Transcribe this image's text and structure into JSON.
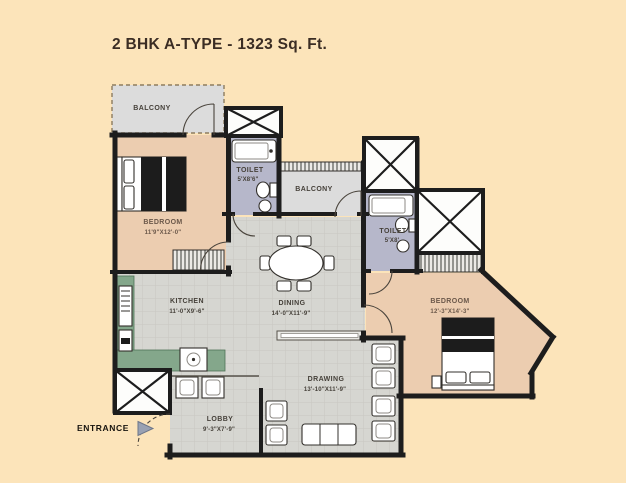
{
  "title": "2 BHK A-TYPE - 1323 Sq. Ft.",
  "entrance": {
    "label": "ENTRANCE"
  },
  "rooms": {
    "balcony_top": {
      "name": "BALCONY"
    },
    "bedroom_left": {
      "name": "BEDROOM",
      "dims": "11'9\"X12'-0\""
    },
    "toilet_top": {
      "name": "TOILET",
      "dims": "5'X8'6\""
    },
    "balcony_mid": {
      "name": "BALCONY"
    },
    "toilet_right": {
      "name": "TOILET",
      "dims": "5'X8'"
    },
    "bedroom_right": {
      "name": "BEDROOM",
      "dims": "12'-3\"X14'-3\""
    },
    "kitchen": {
      "name": "KITCHEN",
      "dims": "11'-0\"X9'-6\""
    },
    "dining": {
      "name": "DINING",
      "dims": "14'-0\"X11'-9\""
    },
    "drawing": {
      "name": "DRAWING",
      "dims": "13'-10\"X11'-9\""
    },
    "lobby": {
      "name": "LOBBY",
      "dims": "9'-3\"X7'-9\""
    }
  },
  "colors": {
    "background": "#fce4ba",
    "wall": "#1d1d1d",
    "bedroom_floor": "#eccdb0",
    "toilet_floor": "#b6b7ca",
    "balcony_floor": "#dcdcdc",
    "hall_floor": "#d6d6d1",
    "kitchen_counter": "#84a78b",
    "entrance_arrow": "#99a1b3",
    "title_text": "#3b2d24"
  }
}
